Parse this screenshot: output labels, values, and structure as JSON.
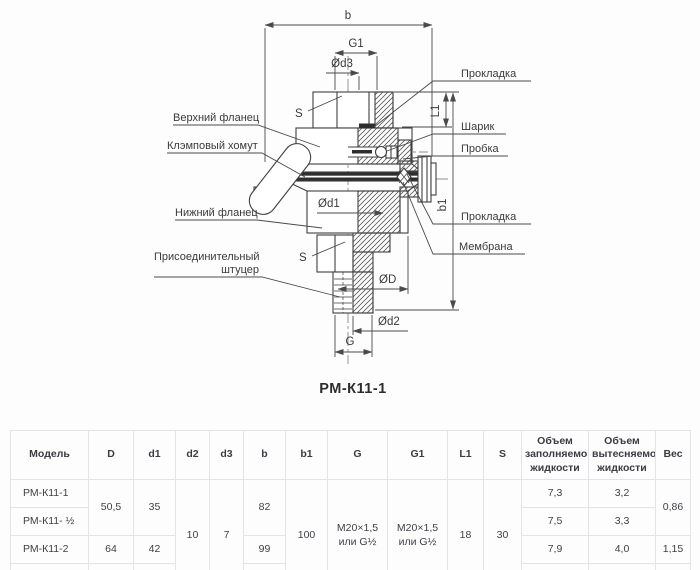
{
  "colors": {
    "line": "#3f3f3f",
    "dark_fill": "#2e2e2e",
    "table_border": "#e4e4e8",
    "text": "#3c3c42",
    "background": "#fdfdfd"
  },
  "drawing": {
    "title": "РМ-К11-1",
    "dim_labels": {
      "b": "b",
      "g1": "G1",
      "od3": "Ød3",
      "s_top": "S",
      "l1": "L1",
      "b1": "b1",
      "od1": "Ød1",
      "s_bottom": "S",
      "od": "ØD",
      "od2": "Ød2",
      "g": "G"
    },
    "callouts": {
      "upper_flange": "Верхний фланец",
      "clamp": "Клэмповый хомут",
      "lower_flange": "Нижний фланец",
      "fitting_line1": "Присоединительный",
      "fitting_line2": "штуцер",
      "gasket_top": "Прокладка",
      "ball": "Шарик",
      "plug": "Пробка",
      "gasket_bottom": "Прокладка",
      "membrane": "Мембрана"
    }
  },
  "table": {
    "headers": [
      "Модель",
      "D",
      "d1",
      "d2",
      "d3",
      "b",
      "b1",
      "G",
      "G1",
      "L1",
      "S",
      "Объем заполняемой жидкости",
      "Объем вытесняемой жидкости",
      "Вес"
    ],
    "rows": [
      {
        "model": "РМ-К11-1",
        "d": "50,5",
        "d1": "35",
        "d2": "10",
        "d3": "7",
        "b": "82",
        "b1": "100",
        "g": "M20×1,5 или G½",
        "g1": "M20×1,5 или G½",
        "l1": "18",
        "s": "30",
        "fill_volume": "7,3",
        "displaced_volume": "3,2",
        "weight": "0,86"
      },
      {
        "model": "РМ-К11- ½",
        "fill_volume": "7,5",
        "displaced_volume": "3,3"
      },
      {
        "model": "РМ-К11-2",
        "d": "64",
        "d1": "42",
        "b": "99",
        "fill_volume": "7,9",
        "displaced_volume": "4,0",
        "weight": "1,15"
      },
      {
        "model": "РМ-К11- ½",
        "d": "77,5",
        "d1": "58",
        "b": "112",
        "fill_volume": "8,5",
        "displaced_volume": "4,1",
        "weight": "1,61"
      }
    ]
  }
}
